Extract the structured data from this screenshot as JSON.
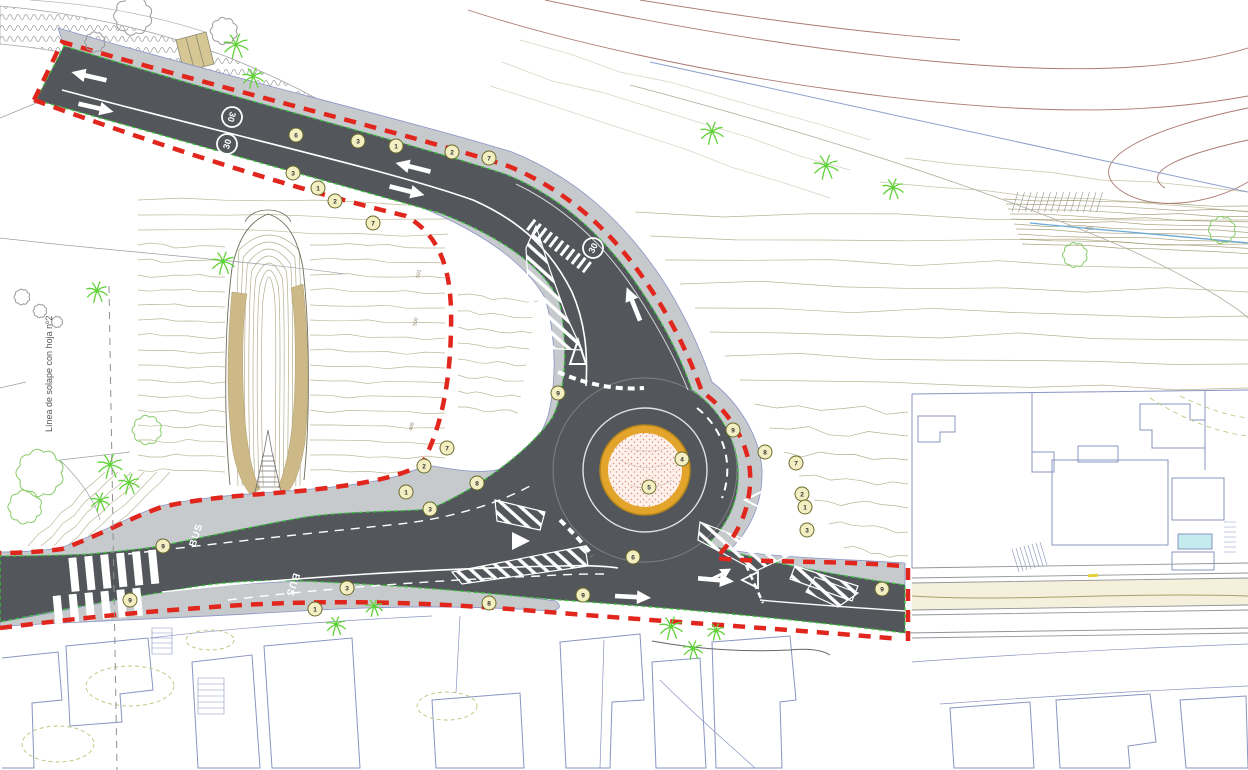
{
  "drawing": {
    "side_note": "Línea de solape con hoja nº2",
    "speed_limit_sign": "30",
    "bus_lane_label": "BUS",
    "colors": {
      "asphalt": "#53575b",
      "sidewalk": "#c7cacc",
      "boundary_red": "#e1261d",
      "island_ring_orange": "#e2a42a",
      "island_fill_pink": "#fdf1ea",
      "contour_olive": "#a39a6c",
      "contour_brown": "#9c6358",
      "building_blue": "#8a94c2",
      "tree_green": "#5fd236",
      "leafy_green": "#86cc66",
      "marking_white": "#ffffff",
      "tan_slope": "#cdb988",
      "water_blue": "#6aaad8",
      "pool_cyan": "#c4ebee"
    },
    "callouts": [
      {
        "n": "6",
        "x": 296,
        "y": 135
      },
      {
        "n": "3",
        "x": 358,
        "y": 141
      },
      {
        "n": "1",
        "x": 396,
        "y": 146
      },
      {
        "n": "2",
        "x": 452,
        "y": 152
      },
      {
        "n": "7",
        "x": 489,
        "y": 158
      },
      {
        "n": "3",
        "x": 293,
        "y": 173
      },
      {
        "n": "1",
        "x": 318,
        "y": 188
      },
      {
        "n": "2",
        "x": 335,
        "y": 201
      },
      {
        "n": "7",
        "x": 373,
        "y": 223
      },
      {
        "n": "7",
        "x": 447,
        "y": 448
      },
      {
        "n": "2",
        "x": 424,
        "y": 466
      },
      {
        "n": "1",
        "x": 406,
        "y": 492
      },
      {
        "n": "3",
        "x": 430,
        "y": 509
      },
      {
        "n": "8",
        "x": 477,
        "y": 483
      },
      {
        "n": "9",
        "x": 558,
        "y": 393
      },
      {
        "n": "9",
        "x": 733,
        "y": 430
      },
      {
        "n": "8",
        "x": 765,
        "y": 452
      },
      {
        "n": "7",
        "x": 796,
        "y": 463
      },
      {
        "n": "2",
        "x": 802,
        "y": 494
      },
      {
        "n": "1",
        "x": 805,
        "y": 507
      },
      {
        "n": "3",
        "x": 807,
        "y": 530
      },
      {
        "n": "6",
        "x": 633,
        "y": 557
      },
      {
        "n": "4",
        "x": 682,
        "y": 459
      },
      {
        "n": "5",
        "x": 649,
        "y": 487
      },
      {
        "n": "9",
        "x": 163,
        "y": 546
      },
      {
        "n": "9",
        "x": 130,
        "y": 600
      },
      {
        "n": "3",
        "x": 347,
        "y": 588
      },
      {
        "n": "1",
        "x": 315,
        "y": 609
      },
      {
        "n": "8",
        "x": 489,
        "y": 603
      },
      {
        "n": "9",
        "x": 583,
        "y": 595
      },
      {
        "n": "9",
        "x": 882,
        "y": 589
      }
    ],
    "speed_roundels": [
      {
        "x": 232,
        "y": 117,
        "rot": 106
      },
      {
        "x": 227,
        "y": 144,
        "rot": -74
      },
      {
        "x": 593,
        "y": 248,
        "rot": -64
      }
    ],
    "bus_markings": [
      {
        "x": 199,
        "y": 536,
        "rot": -72
      },
      {
        "x": 290,
        "y": 584,
        "rot": 108
      }
    ],
    "traffic_arrows": [
      {
        "x": 88,
        "y": 76,
        "rot": 193,
        "type": "straight"
      },
      {
        "x": 97,
        "y": 108,
        "rot": 13,
        "type": "straight"
      },
      {
        "x": 412,
        "y": 167,
        "rot": 194,
        "type": "straight"
      },
      {
        "x": 408,
        "y": 191,
        "rot": 14,
        "type": "straight"
      },
      {
        "x": 633,
        "y": 303,
        "rot": -112,
        "type": "straight"
      },
      {
        "x": 634,
        "y": 597,
        "rot": 3,
        "type": "straight"
      },
      {
        "x": 717,
        "y": 580,
        "rot": 5,
        "type": "fork"
      }
    ],
    "contour_labels": [
      {
        "text": "501",
        "x": 420,
        "y": 274,
        "rot": -80
      },
      {
        "text": "500",
        "x": 417,
        "y": 322,
        "rot": -80
      },
      {
        "text": "499",
        "x": 413,
        "y": 427,
        "rot": -75
      },
      {
        "text": "502",
        "x": 1090,
        "y": 230,
        "rot": -8
      }
    ],
    "trees": {
      "palm": [
        [
          236,
          45,
          13
        ],
        [
          253,
          77,
          11
        ],
        [
          712,
          132,
          12
        ],
        [
          826,
          166,
          13
        ],
        [
          893,
          188,
          11
        ],
        [
          97,
          291,
          11
        ],
        [
          223,
          262,
          12
        ],
        [
          110,
          465,
          13
        ],
        [
          129,
          483,
          11
        ],
        [
          100,
          501,
          10
        ],
        [
          336,
          625,
          10
        ],
        [
          374,
          607,
          9
        ],
        [
          671,
          627,
          12
        ],
        [
          693,
          649,
          10
        ],
        [
          716,
          631,
          9
        ]
      ],
      "leafy": [
        [
          40,
          473,
          21
        ],
        [
          25,
          507,
          15
        ],
        [
          147,
          430,
          13
        ],
        [
          1075,
          255,
          11
        ],
        [
          1222,
          230,
          12
        ]
      ],
      "gray": [
        [
          133,
          16,
          17
        ],
        [
          224,
          31,
          12
        ],
        [
          95,
          42,
          9
        ],
        [
          22,
          297,
          7
        ],
        [
          40,
          311,
          6
        ],
        [
          57,
          322,
          5
        ]
      ]
    }
  }
}
